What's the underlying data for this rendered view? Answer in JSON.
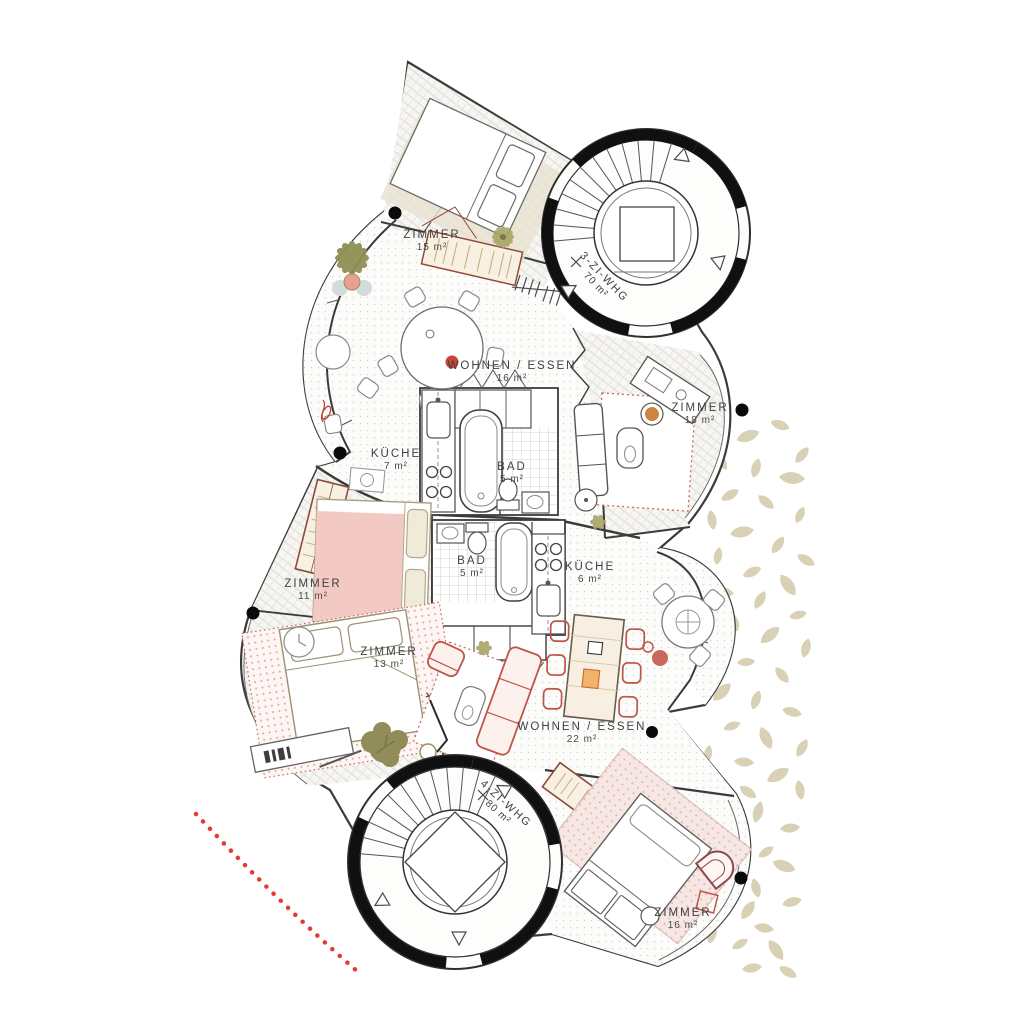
{
  "plan": {
    "apartments": [
      {
        "label": "3-ZI-WHG",
        "area": "70 m²"
      },
      {
        "label": "4-ZI-WHG",
        "area": "80 m²"
      }
    ],
    "rooms": [
      {
        "name": "ZIMMER",
        "area": "15 m²"
      },
      {
        "name": "WOHNEN / ESSEN",
        "area": "16 m²"
      },
      {
        "name": "ZIMMER",
        "area": "18 m²"
      },
      {
        "name": "KÜCHE",
        "area": "7 m²"
      },
      {
        "name": "BAD",
        "area": "5 m²"
      },
      {
        "name": "BAD",
        "area": "5 m²"
      },
      {
        "name": "KÜCHE",
        "area": "6 m²"
      },
      {
        "name": "ZIMMER",
        "area": "11 m²"
      },
      {
        "name": "ZIMMER",
        "area": "13 m²"
      },
      {
        "name": "WOHNEN / ESSEN",
        "area": "22 m²"
      },
      {
        "name": "ZIMMER",
        "area": "16 m²"
      }
    ],
    "colors": {
      "walls": "#3b3b3b",
      "accent_red": "#bf5549",
      "soft_pink": "#f2cac3",
      "leaf_beige": "#d8d1b5",
      "dotted_path_red": "#e63a30",
      "olive_plant": "#8f8f55"
    }
  }
}
